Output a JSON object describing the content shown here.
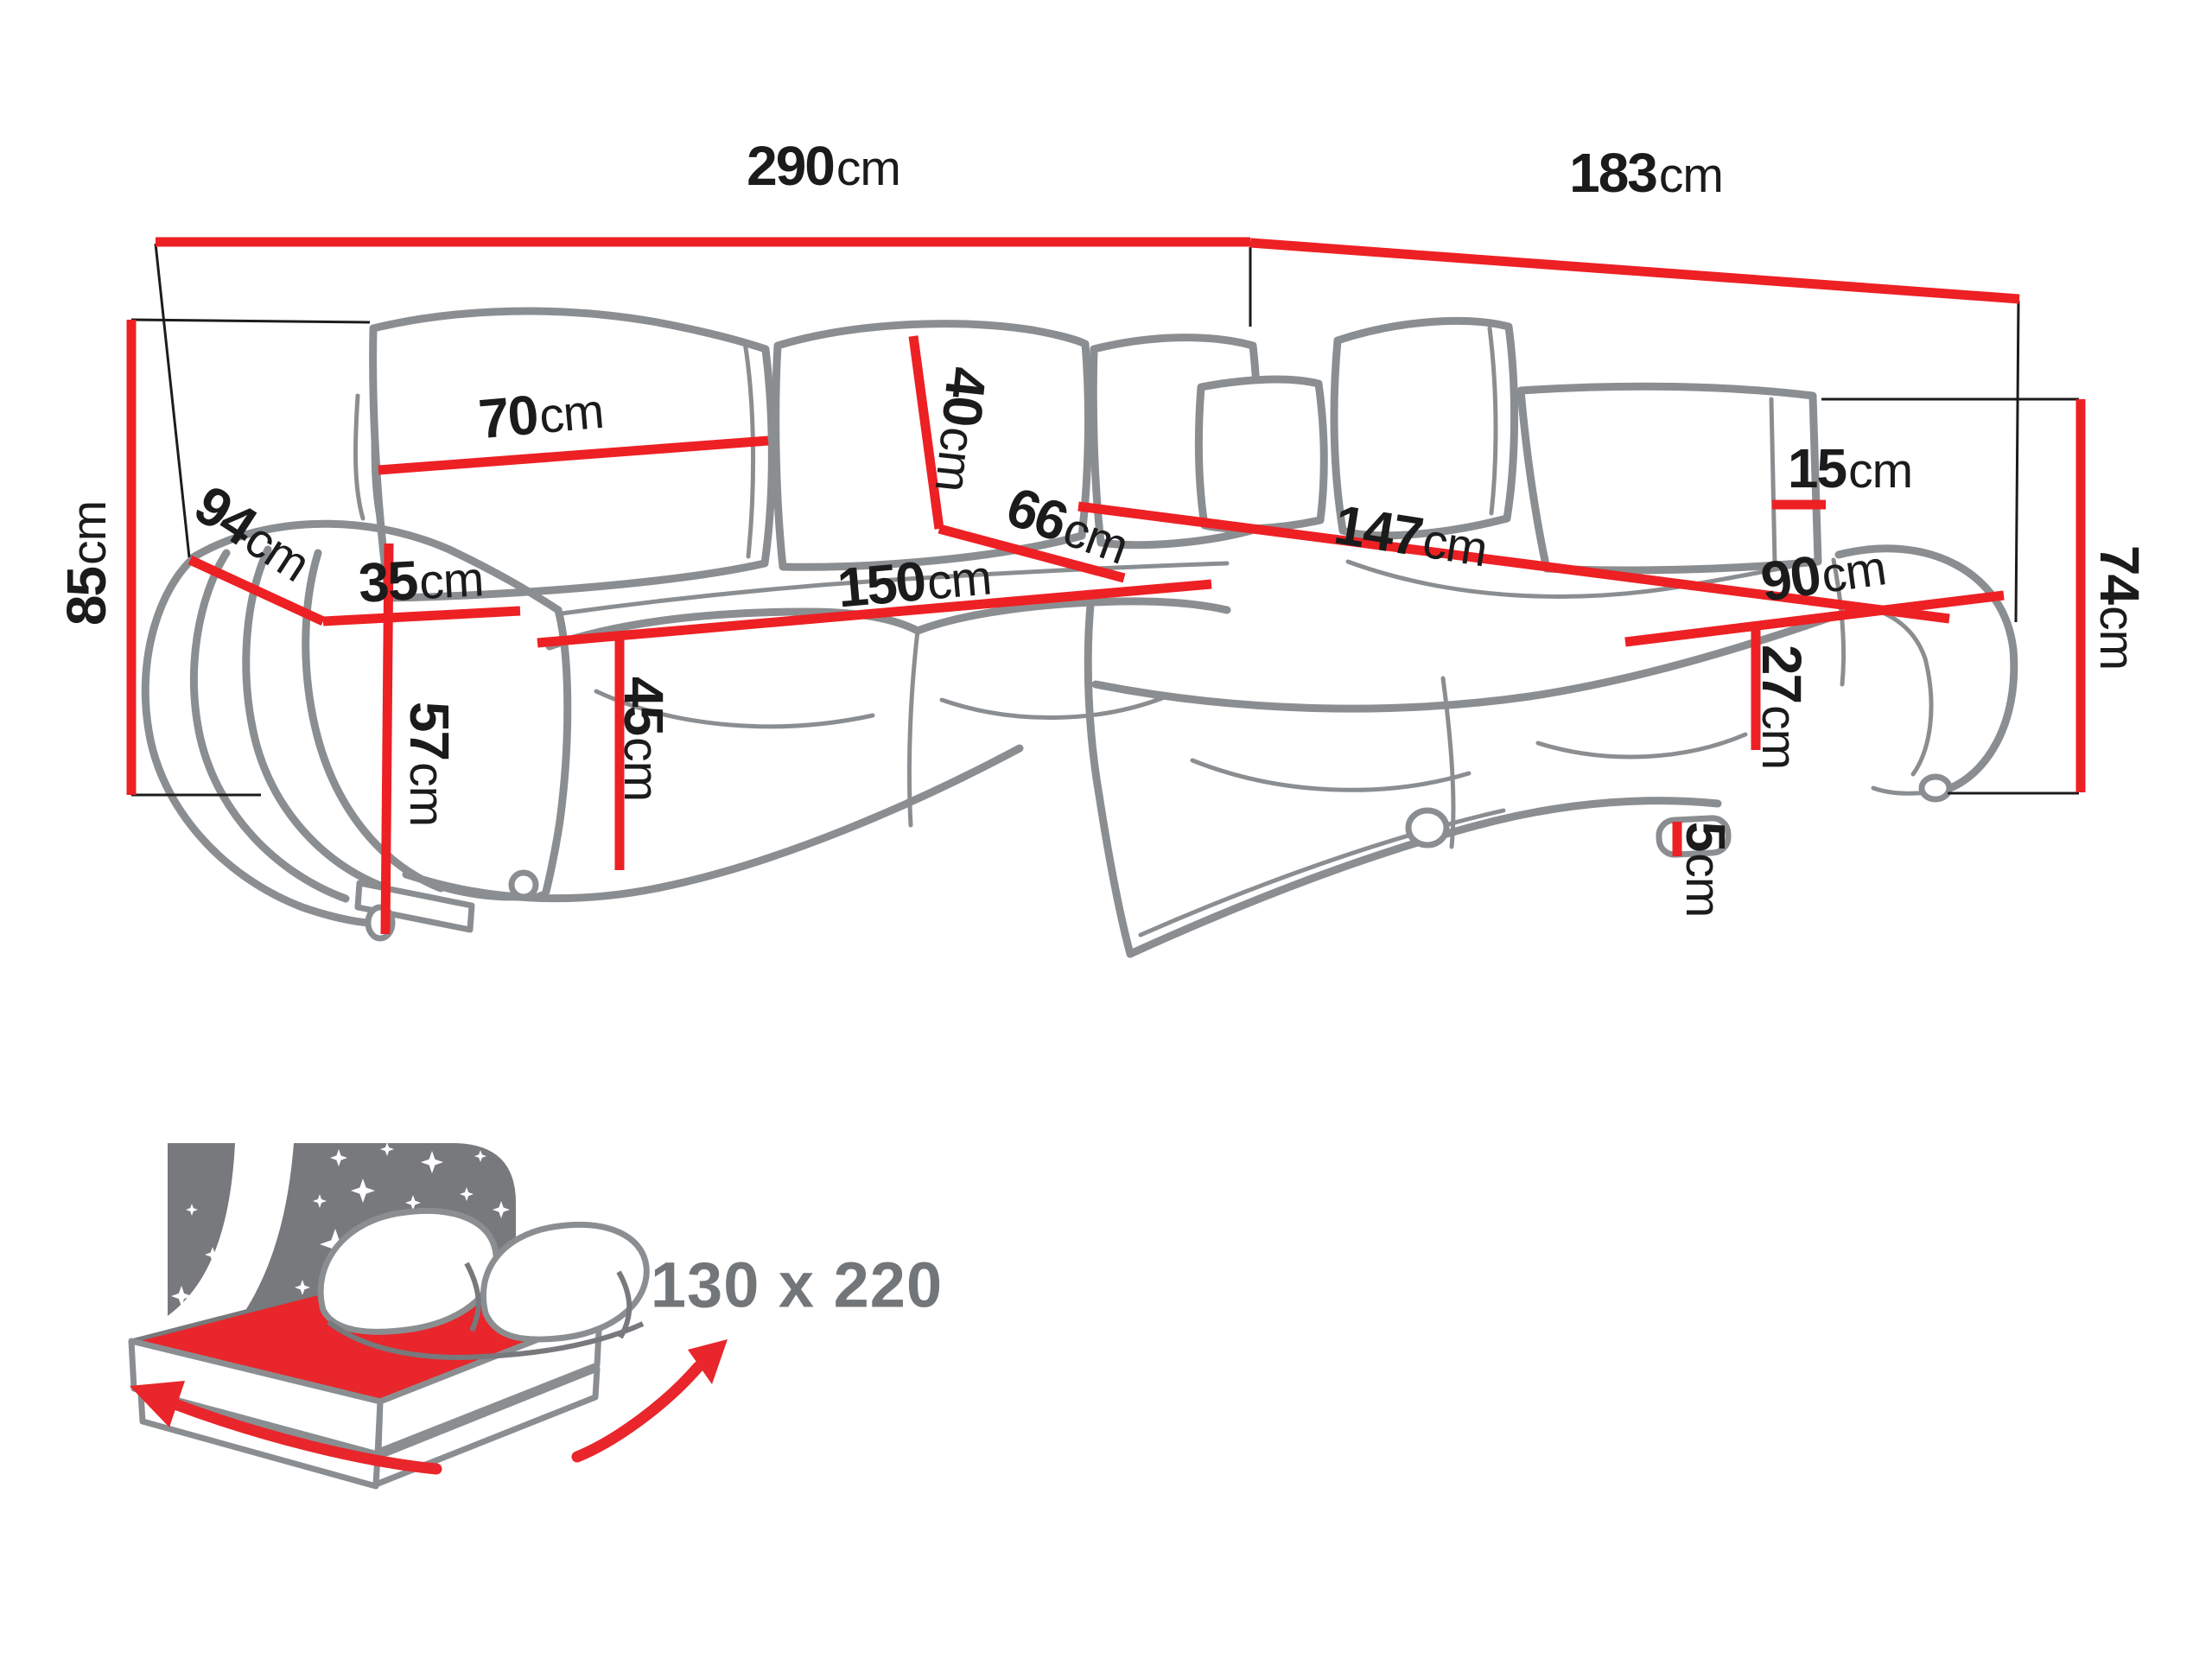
{
  "diagram": {
    "type": "corner-sofa-dimension-diagram",
    "unit": "cm",
    "dimensions": {
      "total_width": {
        "value": "290",
        "unit": "cm"
      },
      "side_width": {
        "value": "183",
        "unit": "cm"
      },
      "total_height": {
        "value": "85",
        "unit": "cm"
      },
      "depth": {
        "value": "94",
        "unit": "cm"
      },
      "armrest_width": {
        "value": "35",
        "unit": "cm"
      },
      "back_cushion_width": {
        "value": "70",
        "unit": "cm"
      },
      "back_cushion_height": {
        "value": "40",
        "unit": "cm"
      },
      "corner_seat_depth": {
        "value": "66",
        "unit": "cm"
      },
      "seat_length": {
        "value": "150",
        "unit": "cm"
      },
      "seat_height": {
        "value": "45",
        "unit": "cm"
      },
      "armrest_height": {
        "value": "57",
        "unit": "cm"
      },
      "chaise_length": {
        "value": "147",
        "unit": "cm"
      },
      "chaise_width": {
        "value": "90",
        "unit": "cm"
      },
      "chaise_side_height": {
        "value": "27",
        "unit": "cm"
      },
      "leg_height": {
        "value": "5",
        "unit": "cm"
      },
      "back_panel_width": {
        "value": "15",
        "unit": "cm"
      },
      "chaise_height": {
        "value": "74",
        "unit": "cm"
      }
    },
    "sleeping_area": {
      "size_label": "130 x 220"
    },
    "colors": {
      "dimension": "#ed2024",
      "outline": "#8b8e91",
      "label_text": "#1b1b1b",
      "size_text": "#737679",
      "icon_red": "#e8262b",
      "icon_gray": "#77797c"
    }
  }
}
